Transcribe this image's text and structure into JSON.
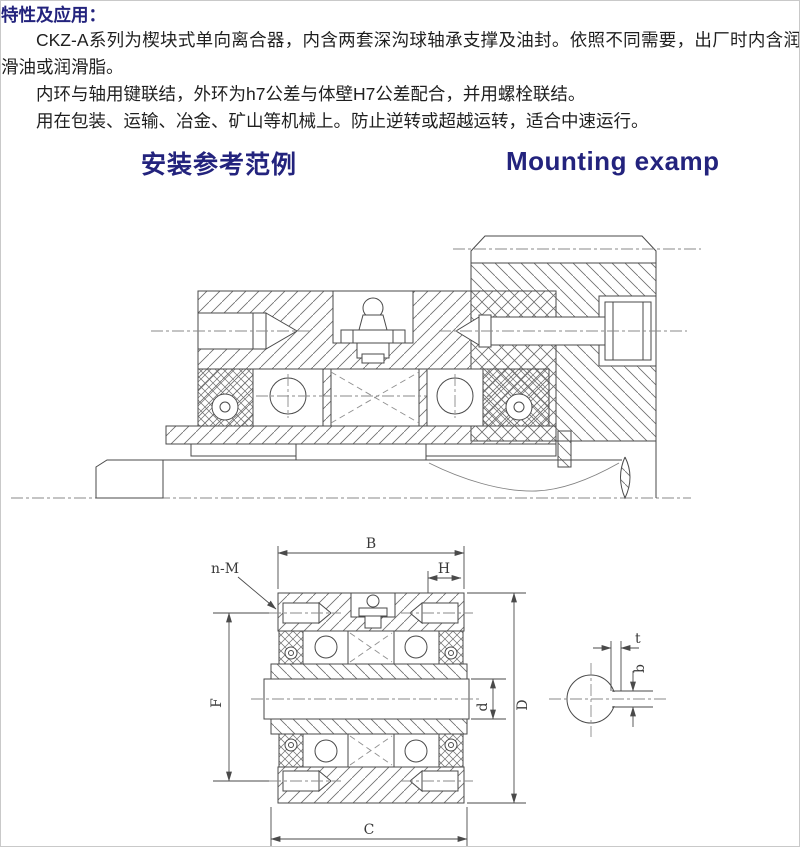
{
  "document": {
    "section_title": "特性及应用：",
    "paragraphs": [
      "CKZ-A系列为楔块式单向离合器，内含两套深沟球轴承支撑及油封。依照不同需要，出厂时内含润滑油或润滑脂。",
      "内环与轴用键联结，外环为h7公差与体壁H7公差配合，并用螺栓联结。",
      "用在包装、运输、冶金、矿山等机械上。防止逆转或超越运转，适合中速运行。"
    ],
    "headings": {
      "zh": "安装参考范例",
      "en": "Mounting examp"
    }
  },
  "drawing_dimensions": {
    "B": "B",
    "H": "H",
    "nM": "n-M",
    "F": "F",
    "d": "d",
    "D": "D",
    "C": "C",
    "t": "t",
    "b": "b"
  },
  "colors": {
    "heading_navy": "#23237d",
    "body_text": "#1f1f1f",
    "line_art": "#4a4a4a",
    "background": "#ffffff"
  }
}
